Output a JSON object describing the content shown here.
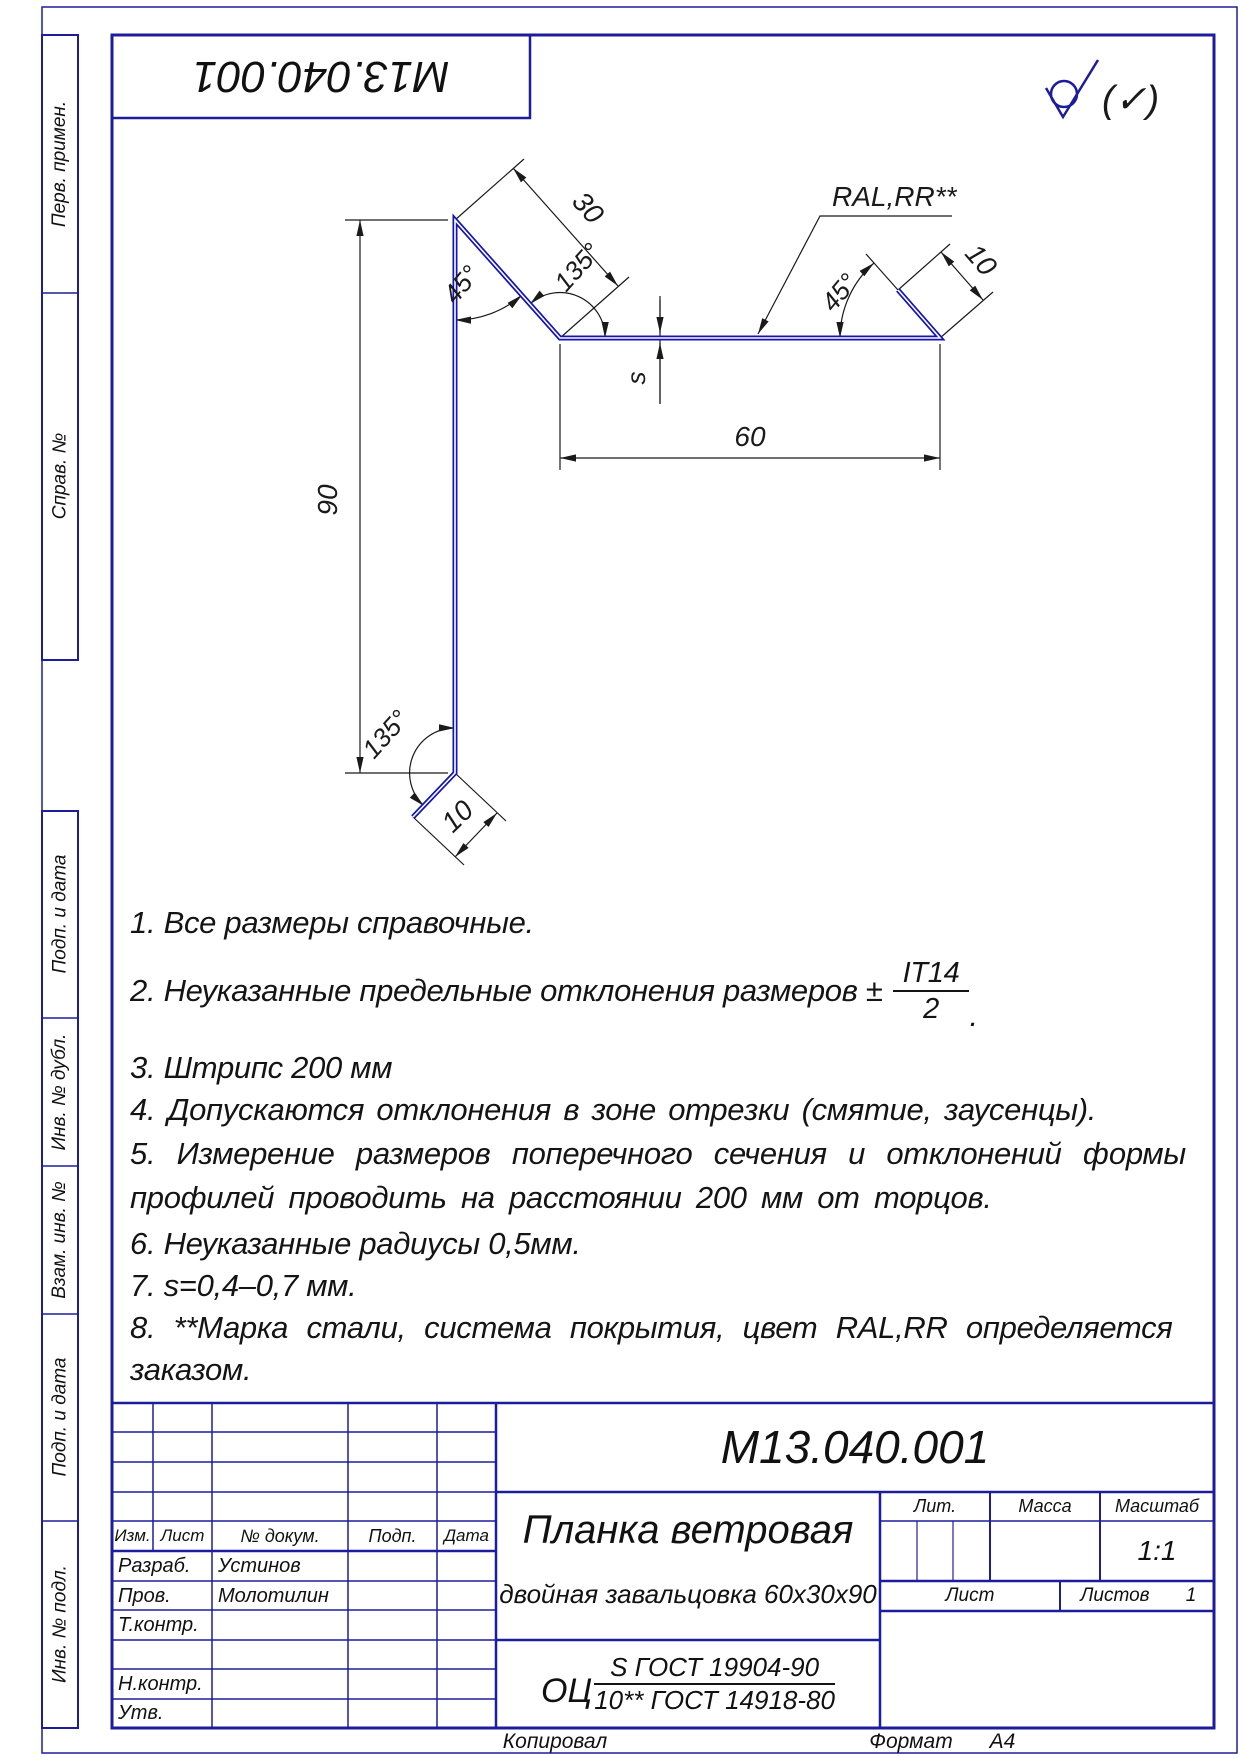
{
  "colors": {
    "frame_blue": "#1d1d9c",
    "profile_blue": "#1414b4",
    "line_black": "#1a1a1a"
  },
  "sheet": {
    "stamp_code": "М13.040.001",
    "roughness_note": "(✓)",
    "kopiroval": "Копировал",
    "format_label": "Формат",
    "format_value": "А4"
  },
  "side_labels": {
    "perv": "Перв. примен.",
    "sprav": "Справ. №",
    "podp1": "Подп. и дата",
    "inv_dubl": "Инв. № дубл.",
    "vzam": "Взам. инв. №",
    "podp2": "Подп. и дата",
    "inv_podl": "Инв. № подл."
  },
  "dims": {
    "height": "90",
    "slope": "30",
    "flat": "60",
    "hem_right": "10",
    "hem_bottom": "10",
    "thickness": "s",
    "angle_left": "45°",
    "angle_top": "135°",
    "angle_right": "45°",
    "angle_bottom": "135°",
    "coating": "RAL,RR**"
  },
  "notes": {
    "n1": "1.  Все размеры справочные.",
    "n2_prefix": "2.  Неуказанные предельные отклонения размеров ±",
    "n2_frac_top": "IT14",
    "n2_frac_bot": "2",
    "n2_suffix": ".",
    "n3": "3.  Штрипс 200 мм",
    "n4": "4.  Допускаются отклонения в зоне отрезки (смятие, заусенцы).",
    "n5a": "5.  Измерение размеров поперечного сечения и отклонений формы",
    "n5b": "профилей проводить на расстоянии 200 мм от торцов.",
    "n6": "6.  Неуказанные радиусы 0,5мм.",
    "n7": "7.  s=0,4–0,7 мм.",
    "n8a": "8.  **Марка стали, система покрытия, цвет RAL,RR определяется",
    "n8b": "заказом."
  },
  "title_block": {
    "doc_number": "М13.040.001",
    "name_line1": "Планка ветровая",
    "name_line2": "двойная завальцовка 60х30х90",
    "material_prefix": "ОЦ",
    "material_top": "S ГОСТ 19904-90",
    "material_bottom": "10** ГОСТ 14918-80",
    "col_izm": "Изм.",
    "col_list": "Лист",
    "col_doc": "№ докум.",
    "col_podp": "Подп.",
    "col_data": "Дата",
    "row_razrab": "Разраб.",
    "row_razrab_name": "Устинов",
    "row_prov": "Пров.",
    "row_prov_name": "Молотилин",
    "row_tkontr": "Т.контр.",
    "row_nkontr": "Н.контр.",
    "row_utv": "Утв.",
    "lit": "Лит.",
    "massa": "Масса",
    "masshtab": "Масштаб",
    "scale": "1:1",
    "list": "Лист",
    "listov": "Листов",
    "listov_value": "1"
  }
}
